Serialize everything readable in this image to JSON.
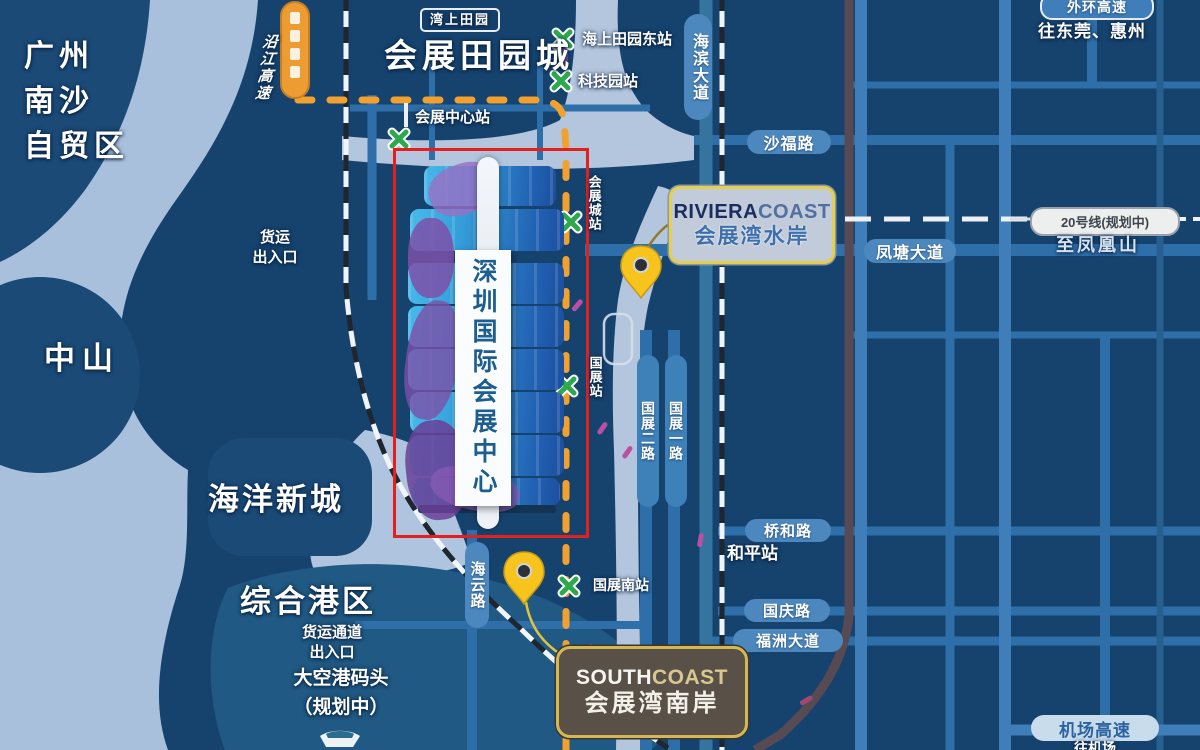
{
  "map": {
    "regions": {
      "nansha": "广州\n南沙\n自贸区",
      "zhongshan": "中山",
      "ocean_new_city": "海洋新城",
      "port_area": "综合港区",
      "wharf": "大空港码头\n（规划中）",
      "garden_city_badge": "湾上田园",
      "garden_city_title": "会展田园城"
    },
    "center": {
      "banner": "深圳国际会展中心"
    },
    "projects": {
      "riviera_en_1": "RIVIERA",
      "riviera_en_2": "COAST",
      "riviera_cn": "会展湾水岸",
      "south_en_1": "SOUTH",
      "south_en_2": "COAST",
      "south_cn": "会展湾南岸"
    },
    "stations": {
      "haishang_tianyuan_east": "海上田园东站",
      "keji_park": "科技园站",
      "huizhan_center": "会展中心站",
      "huizhan_city": "会展城站",
      "guozhan": "国展站",
      "guozhan_south": "国展南站",
      "heping": "和平站"
    },
    "metro": {
      "line_badge": "20号线(规划中)",
      "to_fenghuangshan": "至凤凰山"
    },
    "roads": {
      "yanjiang_expwy": "沿江高速",
      "haibin_ave": "海滨大道",
      "shafu_rd": "沙福路",
      "fengtang_ave": "凤塘大道",
      "waihuan_expwy": "外环高速",
      "to_dongguan_huizhou": "往东莞、惠州",
      "qiaohe_rd": "桥和路",
      "guoqing_rd": "国庆路",
      "fuzhou_ave": "福洲大道",
      "haiyun_rd": "海云路",
      "guozhan_2nd_rd": "国展二路",
      "guozhan_1st_rd": "国展一路",
      "airport_expwy": "机场高速",
      "to_airport": "往机场"
    },
    "gates": {
      "freight_north": "货运\n出入口",
      "freight_south": "货运通道\n出入口"
    }
  }
}
